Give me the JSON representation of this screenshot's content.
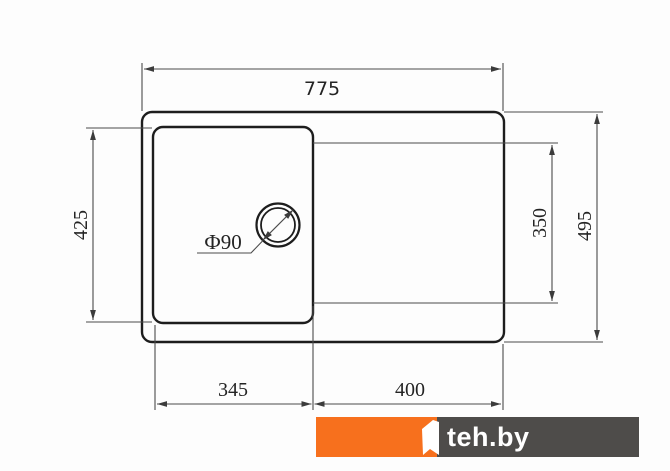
{
  "diagram": {
    "type": "sink dimension drawing, top view",
    "labels": {
      "total_width": "775",
      "bowl_height": "425",
      "drainboard_height": "350",
      "total_height": "495",
      "bowl_width": "345",
      "drainboard_width": "400",
      "drain_hole": "Ф90"
    },
    "colors": {
      "outline": "#1d1d1d",
      "dimension_lines": "#4b4b4b",
      "text": "#242424"
    }
  },
  "watermark": {
    "brand": "teh.by",
    "orange": "#F7701D",
    "bar_gray": "#4E4C4A",
    "glyph": "stylized-1-ribbon"
  }
}
